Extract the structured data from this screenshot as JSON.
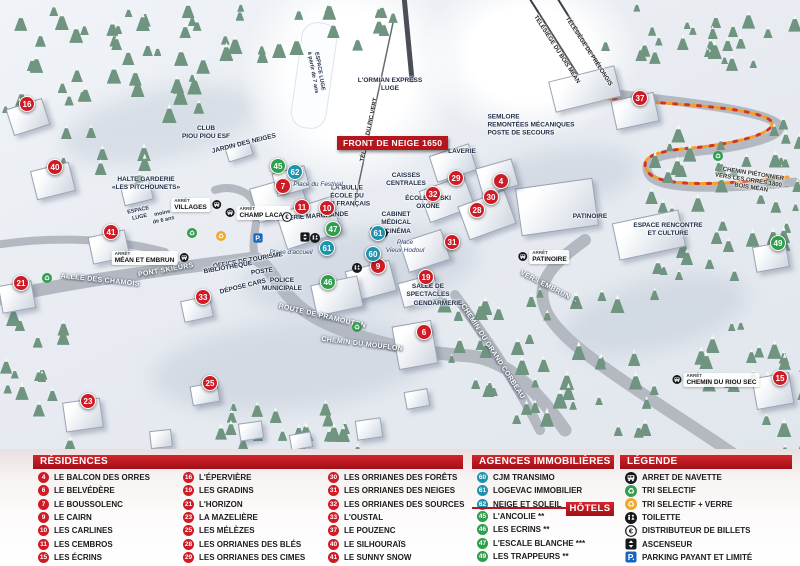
{
  "colors": {
    "header_red": "#b5161d",
    "marker_red": "#ce1b26",
    "agency_blue": "#1f92ad",
    "hotel_green": "#2f9e4d",
    "path_orange": "#f59e20",
    "parking_blue": "#1565c0"
  },
  "map": {
    "banner": "FRONT DE NEIGE 1650",
    "arret_label": "ARRÊT",
    "markers": [
      {
        "n": "16",
        "t": "r",
        "x": 27,
        "y": 104
      },
      {
        "n": "40",
        "t": "r",
        "x": 55,
        "y": 167
      },
      {
        "n": "41",
        "t": "r",
        "x": 111,
        "y": 232
      },
      {
        "n": "21",
        "t": "r",
        "x": 21,
        "y": 283
      },
      {
        "n": "33",
        "t": "r",
        "x": 203,
        "y": 297
      },
      {
        "n": "23",
        "t": "r",
        "x": 88,
        "y": 401
      },
      {
        "n": "25",
        "t": "r",
        "x": 210,
        "y": 383
      },
      {
        "n": "7",
        "t": "r",
        "x": 283,
        "y": 186
      },
      {
        "n": "11",
        "t": "r",
        "x": 302,
        "y": 207
      },
      {
        "n": "10",
        "t": "r",
        "x": 327,
        "y": 208
      },
      {
        "n": "9",
        "t": "r",
        "x": 378,
        "y": 266
      },
      {
        "n": "29",
        "t": "r",
        "x": 456,
        "y": 178
      },
      {
        "n": "32",
        "t": "r",
        "x": 433,
        "y": 194
      },
      {
        "n": "4",
        "t": "r",
        "x": 501,
        "y": 181
      },
      {
        "n": "30",
        "t": "r",
        "x": 491,
        "y": 197
      },
      {
        "n": "28",
        "t": "r",
        "x": 477,
        "y": 210
      },
      {
        "n": "31",
        "t": "r",
        "x": 452,
        "y": 242
      },
      {
        "n": "19",
        "t": "r",
        "x": 426,
        "y": 277
      },
      {
        "n": "6",
        "t": "r",
        "x": 424,
        "y": 332
      },
      {
        "n": "37",
        "t": "r",
        "x": 640,
        "y": 98
      },
      {
        "n": "15",
        "t": "r",
        "x": 780,
        "y": 378
      },
      {
        "n": "62",
        "t": "a",
        "x": 295,
        "y": 172
      },
      {
        "n": "61",
        "t": "a",
        "x": 378,
        "y": 233
      },
      {
        "n": "61",
        "t": "a",
        "x": 327,
        "y": 248
      },
      {
        "n": "60",
        "t": "a",
        "x": 373,
        "y": 254
      },
      {
        "n": "45",
        "t": "h",
        "x": 278,
        "y": 166
      },
      {
        "n": "47",
        "t": "h",
        "x": 333,
        "y": 229
      },
      {
        "n": "46",
        "t": "h",
        "x": 328,
        "y": 282
      },
      {
        "n": "49",
        "t": "h",
        "x": 778,
        "y": 243
      }
    ],
    "labels": [
      {
        "l": [
          "CLUB",
          "PIOU PIOU ESF"
        ],
        "x": 206,
        "y": 133
      },
      {
        "l": [
          "JARDIN DES NEIGES"
        ],
        "x": 244,
        "y": 144,
        "r": -14
      },
      {
        "l": [
          "HALTE GARDERIE",
          "«LES PITCHOUNETS»"
        ],
        "x": 146,
        "y": 184
      },
      {
        "l": [
          "ESPACE",
          "LUGE"
        ],
        "x": 139,
        "y": 214,
        "r": -12,
        "c": "tiny"
      },
      {
        "l": [
          "moins",
          "de 6 ans"
        ],
        "x": 163,
        "y": 217,
        "r": -12,
        "c": "tiny"
      },
      {
        "l": [
          "LA BULLE",
          "ÉCOLE DU",
          "SKI FRANÇAIS"
        ],
        "x": 347,
        "y": 196
      },
      {
        "l": [
          "Place du Festival"
        ],
        "x": 318,
        "y": 185,
        "c": "place"
      },
      {
        "l": [
          "GALERIE MARCHANDE"
        ],
        "x": 312,
        "y": 217,
        "r": -4
      },
      {
        "l": [
          "CAISSES",
          "CENTRALES"
        ],
        "x": 406,
        "y": 180
      },
      {
        "l": [
          "LAVERIE"
        ],
        "x": 462,
        "y": 152
      },
      {
        "l": [
          "ÉCOLE DE SKI",
          "OXONE"
        ],
        "x": 428,
        "y": 203
      },
      {
        "l": [
          "CABINET",
          "MÉDICAL"
        ],
        "x": 396,
        "y": 219
      },
      {
        "l": [
          "CINÉMA"
        ],
        "x": 398,
        "y": 232
      },
      {
        "l": [
          "Place",
          "Vieux Hodoul"
        ],
        "x": 405,
        "y": 247,
        "c": "place"
      },
      {
        "l": [
          "Place d'accueil"
        ],
        "x": 291,
        "y": 253,
        "c": "place"
      },
      {
        "l": [
          "OFFICE DE TOURISME"
        ],
        "x": 248,
        "y": 261,
        "r": -10
      },
      {
        "l": [
          "BIBLIOTHÈQUE"
        ],
        "x": 228,
        "y": 268,
        "r": -10
      },
      {
        "l": [
          "POSTE"
        ],
        "x": 262,
        "y": 272,
        "r": -8
      },
      {
        "l": [
          "POLICE",
          "MUNICIPALE"
        ],
        "x": 282,
        "y": 285
      },
      {
        "l": [
          "DÉPOSE CARS"
        ],
        "x": 243,
        "y": 287,
        "r": -14
      },
      {
        "l": [
          "SALLE DE",
          "SPECTACLES"
        ],
        "x": 428,
        "y": 291
      },
      {
        "l": [
          "GENDARMERIE"
        ],
        "x": 438,
        "y": 304
      },
      {
        "l": [
          "PATINOIRE"
        ],
        "x": 590,
        "y": 217
      },
      {
        "l": [
          "ESPACE RENCONTRE",
          "ET CULTURE"
        ],
        "x": 668,
        "y": 230
      },
      {
        "l": [
          "SEMLORE",
          "REMONTÉES MÉCANIQUES",
          "POSTE DE SECOURS"
        ],
        "x": 531,
        "y": 125,
        "c": "fac-left"
      },
      {
        "l": [
          "L'ORMIAN EXPRESS",
          "LUGE"
        ],
        "x": 390,
        "y": 85
      },
      {
        "l": [
          "ESPACE LUGE",
          "à partir de 7 ans"
        ],
        "x": 316,
        "y": 72,
        "r": 80,
        "c": "tiny"
      },
      {
        "l": [
          "TÉLÉSKI DU PIC VERT"
        ],
        "x": 370,
        "y": 130,
        "r": -78,
        "c": "lift"
      },
      {
        "l": [
          "TÉLÉSIÈGE DU BOIS MÉAN"
        ],
        "x": 556,
        "y": 50,
        "r": 57,
        "c": "lift"
      },
      {
        "l": [
          "TÉLÉSIÈGE DE PRÉLONGIS"
        ],
        "x": 588,
        "y": 52,
        "r": 57,
        "c": "lift"
      },
      {
        "l": [
          "ALLÉE DES CHAMOIS"
        ],
        "x": 100,
        "y": 281,
        "r": 6,
        "c": "road"
      },
      {
        "l": [
          "PONT SKIEURS"
        ],
        "x": 166,
        "y": 271,
        "r": -10,
        "c": "road"
      },
      {
        "l": [
          "ROUTE DE PRAMOUTON"
        ],
        "x": 322,
        "y": 317,
        "r": 13,
        "c": "road"
      },
      {
        "l": [
          "CHEMIN DU MOUFLON"
        ],
        "x": 362,
        "y": 345,
        "r": 7,
        "c": "road"
      },
      {
        "l": [
          "CHEMIN DU GRAND CORBEAU"
        ],
        "x": 492,
        "y": 352,
        "r": 57,
        "c": "road"
      },
      {
        "l": [
          "VERS EMBRUN →"
        ],
        "x": 549,
        "y": 288,
        "r": 27,
        "c": "road"
      },
      {
        "l": [
          "CHEMIN PIÉTONNIER",
          "VERS LES ORRES 1800 →",
          "BOIS MÉAN"
        ],
        "x": 752,
        "y": 182,
        "r": 9,
        "c": "halo"
      }
    ],
    "bus_stops": [
      {
        "name": "VILLAGES",
        "x": 196,
        "y": 205,
        "icon": "right"
      },
      {
        "name": "CHAMP LACAS",
        "x": 258,
        "y": 213,
        "icon": "left"
      },
      {
        "name": "MÉAN ET EMBRUN",
        "x": 150,
        "y": 258,
        "icon": "right"
      },
      {
        "name": "PATINOIRE",
        "x": 544,
        "y": 257,
        "icon": "left"
      },
      {
        "name": "CHEMIN DU RIOU SEC",
        "x": 716,
        "y": 380,
        "icon": "left"
      }
    ],
    "icons": [
      {
        "k": "recycle-green",
        "x": 47,
        "y": 278
      },
      {
        "k": "recycle-green",
        "x": 192,
        "y": 233
      },
      {
        "k": "recycle-green",
        "x": 357,
        "y": 327
      },
      {
        "k": "recycle-green",
        "x": 718,
        "y": 156
      },
      {
        "k": "recycle-yellow",
        "x": 221,
        "y": 236
      },
      {
        "k": "euro",
        "x": 287,
        "y": 217
      },
      {
        "k": "parking",
        "x": 258,
        "y": 238
      },
      {
        "k": "elevator",
        "x": 305,
        "y": 237
      },
      {
        "k": "toilet",
        "x": 315,
        "y": 238
      },
      {
        "k": "elevator",
        "x": 375,
        "y": 232
      },
      {
        "k": "toilet",
        "x": 383,
        "y": 233
      },
      {
        "k": "toilet",
        "x": 357,
        "y": 268
      }
    ]
  },
  "panel": {
    "residences": {
      "title": "RÉSIDENCES",
      "items": [
        {
          "n": "4",
          "name": "LE BALCON DES ORRES"
        },
        {
          "n": "6",
          "name": "LE BELVÉDÈRE"
        },
        {
          "n": "7",
          "name": "LE BOUSSOLENC"
        },
        {
          "n": "9",
          "name": "LE CAIRN"
        },
        {
          "n": "10",
          "name": "LES CARLINES"
        },
        {
          "n": "11",
          "name": "LES CEMBROS"
        },
        {
          "n": "15",
          "name": "LES ÉCRINS"
        },
        {
          "n": "16",
          "name": "L'ÉPERVIÈRE"
        },
        {
          "n": "19",
          "name": "LES GRADINS"
        },
        {
          "n": "21",
          "name": "L'HORIZON"
        },
        {
          "n": "23",
          "name": "LA MAZELIÈRE"
        },
        {
          "n": "25",
          "name": "LES MÉLÈZES"
        },
        {
          "n": "28",
          "name": "LES ORRIANES DES BLÉS"
        },
        {
          "n": "29",
          "name": "LES ORRIANES DES CIMES"
        },
        {
          "n": "30",
          "name": "LES ORRIANES DES FORÊTS"
        },
        {
          "n": "31",
          "name": "LES ORRIANES DES NEIGES"
        },
        {
          "n": "32",
          "name": "LES ORRIANES DES SOURCES"
        },
        {
          "n": "33",
          "name": "L'OUSTAL"
        },
        {
          "n": "37",
          "name": "LE POUZENC"
        },
        {
          "n": "40",
          "name": "LE SILHOURAÏS"
        },
        {
          "n": "41",
          "name": "LE SUNNY SNOW"
        }
      ]
    },
    "agences": {
      "title": "AGENCES IMMOBILIÈRES",
      "items": [
        {
          "n": "60",
          "name": "CJM TRANSIMO"
        },
        {
          "n": "61",
          "name": "LOGEVAC IMMOBILIER"
        },
        {
          "n": "62",
          "name": "NEIGE ET SOLEIL"
        }
      ]
    },
    "hotels": {
      "title": "HÔTELS",
      "items": [
        {
          "n": "45",
          "name": "L'ANCOLIE **"
        },
        {
          "n": "46",
          "name": "LES ECRINS **"
        },
        {
          "n": "47",
          "name": "L'ESCALE BLANCHE ***"
        },
        {
          "n": "49",
          "name": "LES TRAPPEURS **"
        }
      ]
    },
    "legende": {
      "title": "LÉGENDE",
      "items": [
        {
          "icon": "bus",
          "label": "ARRET DE NAVETTE"
        },
        {
          "icon": "recycle-green",
          "label": "TRI SELECTIF"
        },
        {
          "icon": "recycle-yellow",
          "label": "TRI SELECTIF + VERRE"
        },
        {
          "icon": "toilet",
          "label": "TOILETTE"
        },
        {
          "icon": "euro",
          "label": "DISTRIBUTEUR DE BILLETS"
        },
        {
          "icon": "elevator",
          "label": "ASCENSEUR"
        },
        {
          "icon": "parking",
          "label": "PARKING PAYANT ET LIMITÉ"
        }
      ]
    }
  }
}
